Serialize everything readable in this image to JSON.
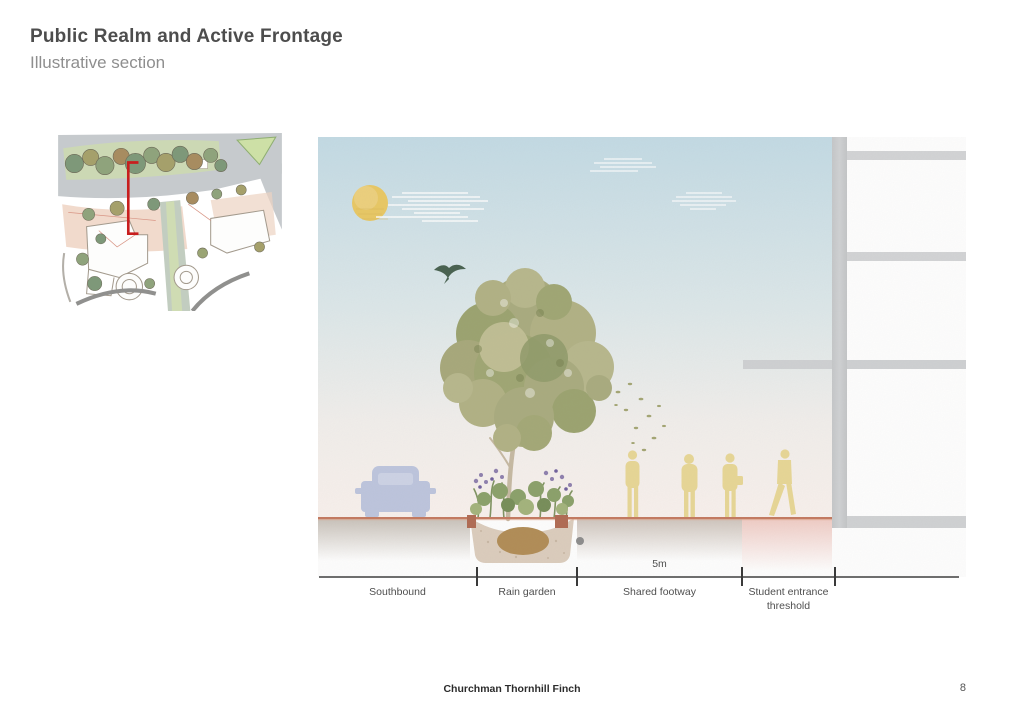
{
  "header": {
    "title": "Public Realm and Active Frontage",
    "subtitle": "Illustrative section"
  },
  "key_plan": {
    "name": "site key plan",
    "marker": "red section-cut marker"
  },
  "illustration": {
    "elements": [
      "sun",
      "clouds",
      "swallow-bird",
      "street-tree",
      "car-silhouette",
      "rain-garden-planter",
      "pedestrians",
      "falling-leaves",
      "building-facade"
    ]
  },
  "dimension": {
    "value": "5m"
  },
  "section_labels": [
    {
      "label": "Southbound"
    },
    {
      "label": "Rain garden"
    },
    {
      "label": "Shared footway"
    },
    {
      "label": "Student entrance threshold"
    }
  ],
  "footer": {
    "company": "Churchman Thornhill Finch",
    "page_number": "8"
  },
  "colors": {
    "accent_red": "#c81e1e",
    "ground_line": "#c4795f",
    "people": "#e8d795",
    "car": "#bdc5de",
    "concrete": "#caccce",
    "sun": "#e9c863",
    "sky_top": "#c3dbe5"
  }
}
